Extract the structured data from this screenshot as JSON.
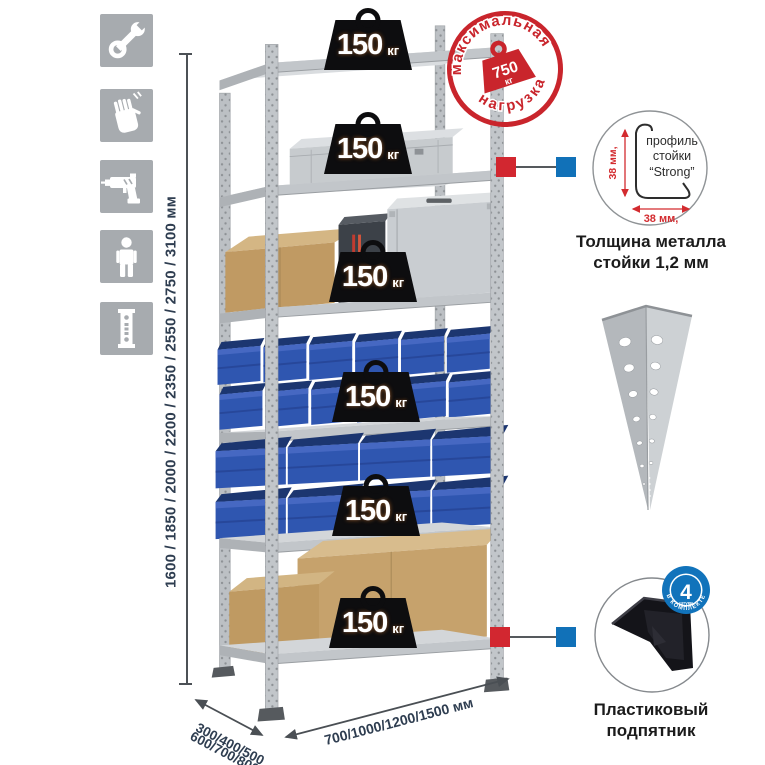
{
  "shelf": {
    "load_badges": [
      {
        "value": "150",
        "unit": "кг"
      },
      {
        "value": "150",
        "unit": "кг"
      },
      {
        "value": "150",
        "unit": "кг"
      },
      {
        "value": "150",
        "unit": "кг"
      },
      {
        "value": "150",
        "unit": "кг"
      },
      {
        "value": "150",
        "unit": "кг"
      }
    ]
  },
  "max_load_stamp": {
    "top_text": "максимальная",
    "bottom_text": "нагрузка",
    "value": "750",
    "unit": "кг"
  },
  "dimensions": {
    "height": "1600 / 1850 / 2000 / 2200 / 2350 / 2550 / 2750 / 3100 мм",
    "depth_line1": "300/400/500",
    "depth_line2": "600/700/800 мм",
    "width": "700/1000/1200/1500 мм"
  },
  "profile_detail": {
    "label_line1": "профиль",
    "label_line2": "стойки",
    "label_line3": "“Strong”",
    "dim_vertical": "38 мм,",
    "dim_horizontal": "38 мм,",
    "caption_line1": "Толщина металла",
    "caption_line2": "стойки 1,2 мм"
  },
  "foot_detail": {
    "count": "4",
    "count_label": "штуки",
    "ring_label": "В КОМПЛЕКТЕ",
    "caption_line1": "Пластиковый",
    "caption_line2": "подпятник"
  },
  "icons": {
    "items": [
      "wrench",
      "gloves",
      "drill",
      "person",
      "post-profile"
    ]
  },
  "colors": {
    "accent_red": "#c9252c",
    "accent_blue": "#1171b8",
    "metal": "#c9cdd0",
    "bin_blue": "#2f56b0",
    "dimension_text": "#2e3d50"
  }
}
